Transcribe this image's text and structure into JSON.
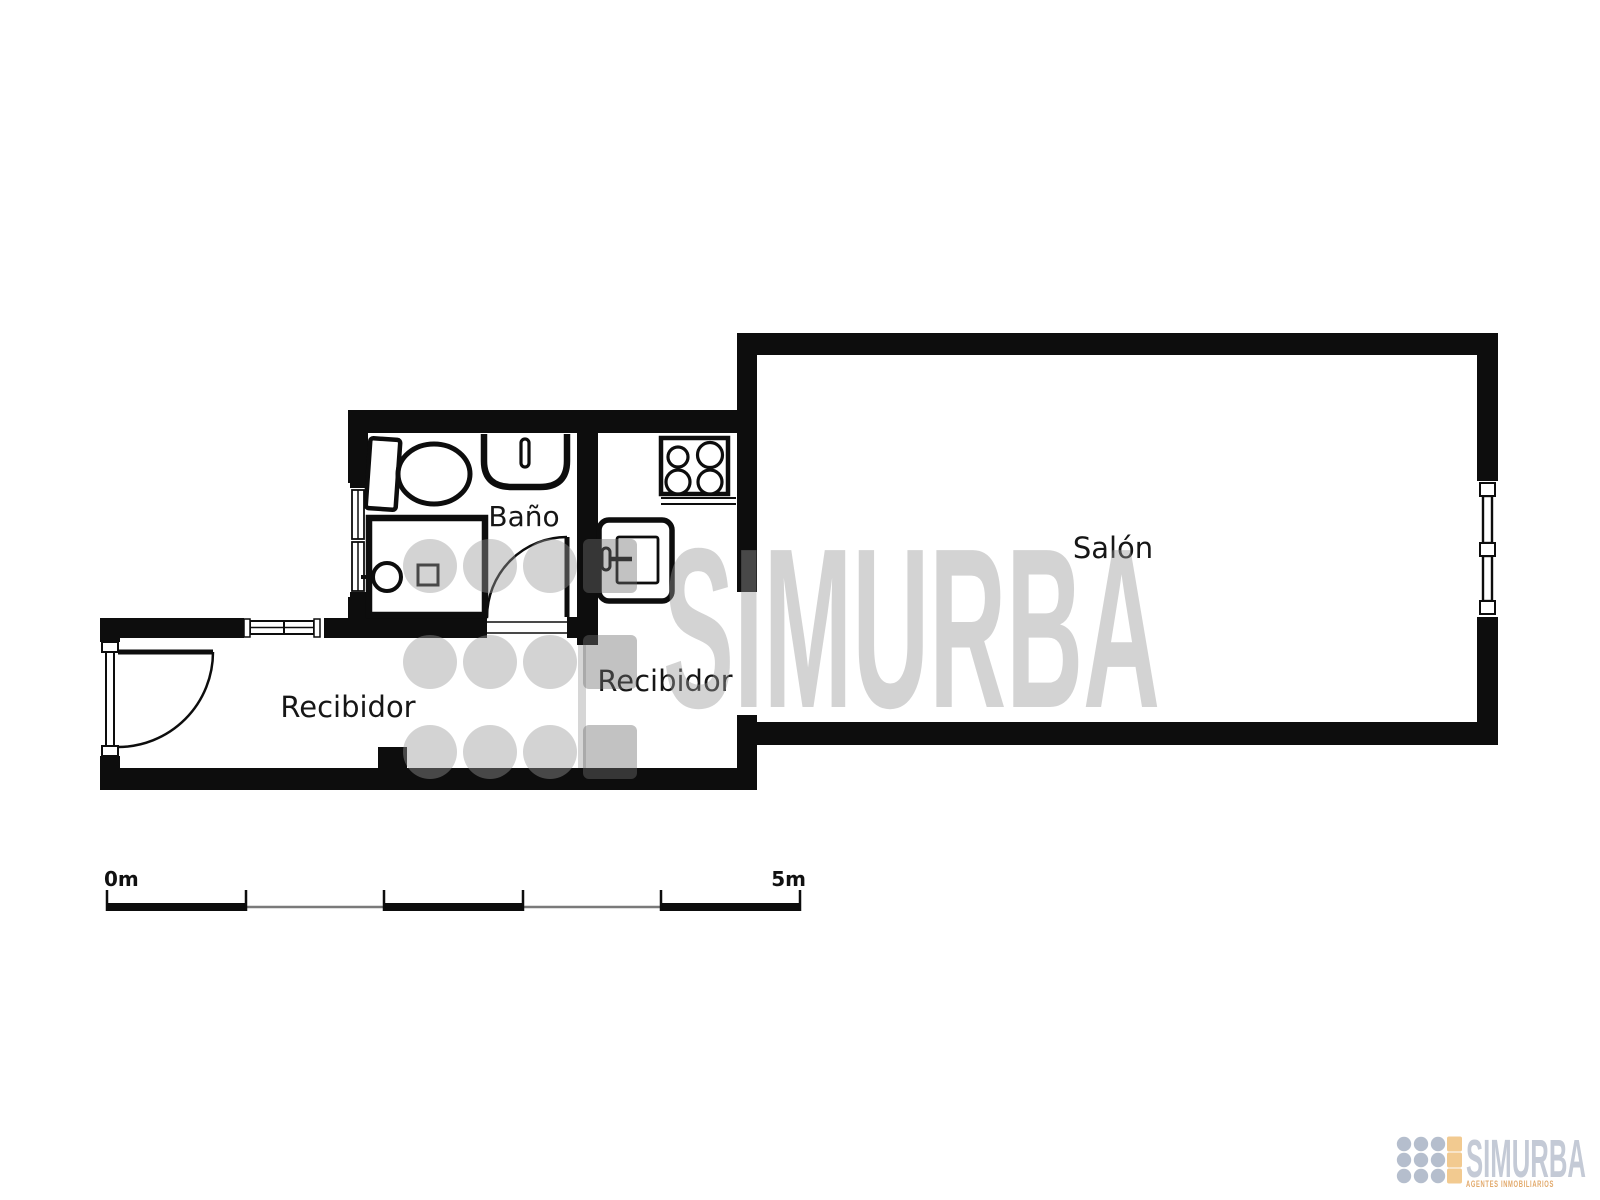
{
  "floor_plan": {
    "type": "apartment-floor-plan",
    "rooms": [
      {
        "id": "bano",
        "label": "Baño"
      },
      {
        "id": "recibidor_left",
        "label": "Recibidor"
      },
      {
        "id": "recibidor_right",
        "label": "Recibidor"
      },
      {
        "id": "salon",
        "label": "Salón"
      }
    ],
    "fixtures": [
      "toilet",
      "washbasin",
      "shower",
      "stove-4-burners",
      "kitchen-sink"
    ],
    "doors": [
      "entrance-door-swing",
      "bathroom-door-swing"
    ],
    "windows": [
      "recibidor-top-window",
      "bathroom-left-window",
      "salon-right-window"
    ],
    "scale_bar": {
      "start_label": "0m",
      "end_label": "5m",
      "divisions": 5
    },
    "watermark": {
      "text": "SIMURBA"
    },
    "logo": {
      "brand": "SIMURBA",
      "tagline": "AGENTES INMOBILIARIOS"
    },
    "colors": {
      "wall": "#0d0d0d",
      "background": "#ffffff",
      "watermark_gray": "#999999",
      "watermark_accent": "#6f6f6f",
      "logo_text": "#c4cad6",
      "logo_dot": "#b5becd",
      "logo_accent": "#f2ca90",
      "tagline_orange": "#e2a96b"
    }
  }
}
